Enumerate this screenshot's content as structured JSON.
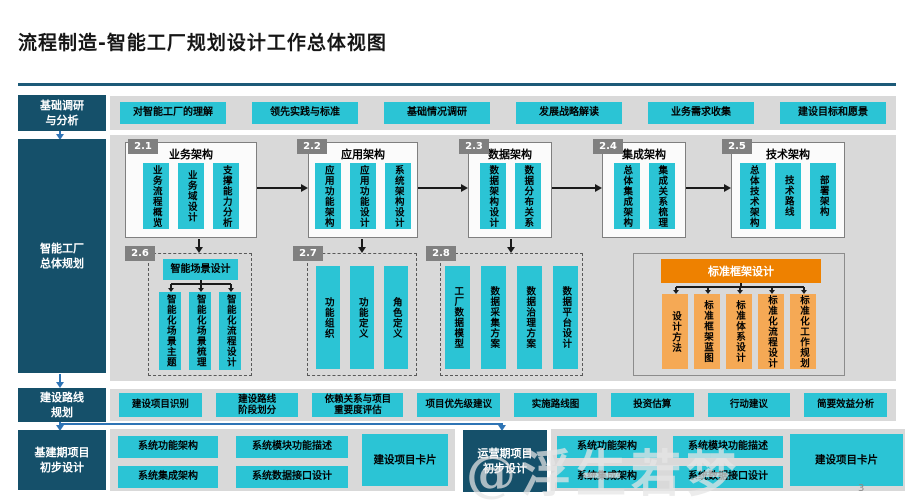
{
  "slide": {
    "title": "流程制造-智能工厂规划设计工作总体视图",
    "page_number": "3",
    "watermark": "@浮生若梦"
  },
  "colors": {
    "sidebar_dark_teal": "#15506a",
    "box_cyan": "#2bc4d5",
    "row_gray": "#d9d9d9",
    "badge_gray": "#808080",
    "orange_header": "#ee8100",
    "orange_box": "#f5a955",
    "connector_blue": "#2e74b5",
    "connector_black": "#1a1a1a"
  },
  "survey": {
    "sidebar": "基础调研\n与分析",
    "items": [
      "对智能工厂的理解",
      "领先实践与标准",
      "基础情况调研",
      "发展战略解读",
      "业务需求收集",
      "建设目标和愿景"
    ]
  },
  "planning": {
    "sidebar": "智能工厂\n总体规划",
    "arch_panels": [
      {
        "badge": "2.1",
        "title": "业务架构",
        "boxes": [
          "业务流程概览",
          "业务域设计",
          "支撑能力分析"
        ]
      },
      {
        "badge": "2.2",
        "title": "应用架构",
        "boxes": [
          "应用功能架构",
          "应用功能设计",
          "系统架构设计"
        ]
      },
      {
        "badge": "2.3",
        "title": "数据架构",
        "boxes": [
          "数据架构设计",
          "数据分布关系"
        ]
      },
      {
        "badge": "2.4",
        "title": "集成架构",
        "boxes": [
          "总体集成架构",
          "集成关系梳理"
        ]
      },
      {
        "badge": "2.5",
        "title": "技术架构",
        "boxes": [
          "总体技术架构",
          "技术路线",
          "部署架构"
        ]
      }
    ],
    "scene_panel": {
      "badge": "2.6",
      "header": "智能场景设计",
      "boxes": [
        "智能化场景主题",
        "智能化场景梳理",
        "智能化流程设计"
      ]
    },
    "function_panel": {
      "badge": "2.7",
      "boxes": [
        "功能组织",
        "功能定义",
        "角色定义"
      ]
    },
    "data_panel": {
      "badge": "2.8",
      "boxes": [
        "工厂数据模型",
        "数据采集方案",
        "数据治理方案",
        "数据平台设计"
      ]
    },
    "standard_panel": {
      "header": "标准框架设计",
      "boxes": [
        "设计方法",
        "标准框架蓝图",
        "标准体系设计",
        "标准化流程设计",
        "标准化工作规划"
      ]
    }
  },
  "roadmap": {
    "sidebar": "建设路线\n规划",
    "items": [
      "建设项目识别",
      "建设路线\n阶段划分",
      "依赖关系与项目\n重要度评估",
      "项目优先级建议",
      "实施路线图",
      "投资估算",
      "行动建议",
      "简要效益分析"
    ]
  },
  "construction": {
    "sidebar": "基建期项目\n初步设计",
    "boxes": [
      "系统功能架构",
      "系统模块功能描述",
      "系统集成架构",
      "系统数据接口设计"
    ],
    "card": "建设项目卡片"
  },
  "operation": {
    "sidebar": "运营期项目\n初步设计",
    "boxes": [
      "系统功能架构",
      "系统模块功能描述",
      "系统集成架构",
      "系统数据接口设计"
    ],
    "card": "建设项目卡片"
  }
}
